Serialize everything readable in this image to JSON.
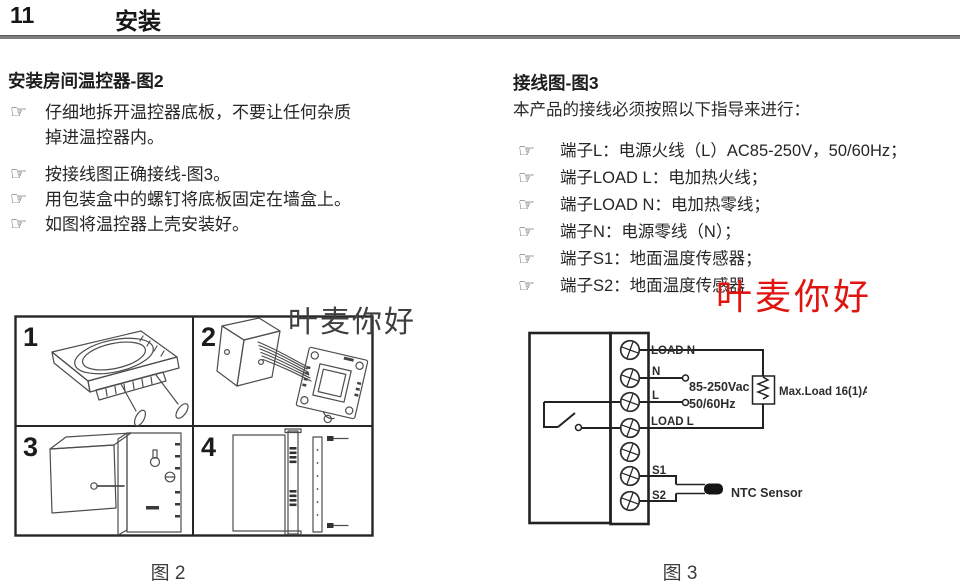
{
  "header": {
    "section_number": "11",
    "section_title": "安装"
  },
  "icons": {
    "hand": "☞"
  },
  "left": {
    "heading": "安装房间温控器-图2",
    "bullets": [
      "仔细地拆开温控器底板，不要让任何杂质掉进温控器内。",
      "按接线图正确接线-图3。",
      "用包装盒中的螺钉将底板固定在墙盒上。",
      "如图将温控器上壳安装好。"
    ],
    "figure": {
      "panels": [
        "1",
        "2",
        "3",
        "4"
      ],
      "caption": "图 2"
    }
  },
  "right": {
    "heading": "接线图-图3",
    "intro": "本产品的接线必须按照以下指导来进行：",
    "bullets": [
      "端子L：电源火线（L）AC85-250V，50/60Hz；",
      "端子LOAD L：电加热火线；",
      "端子LOAD N：电加热零线；",
      "端子N：电源零线（N）；",
      "端子S1：地面温度传感器；",
      "端子S2：地面温度传感器"
    ],
    "figure": {
      "terminals": [
        "LOAD N",
        "N",
        "L",
        "LOAD L",
        "S1",
        "S2"
      ],
      "voltage": "85-250Vac",
      "frequency": "50/60Hz",
      "max_load": "Max.Load 16(1)A",
      "sensor": "NTC Sensor",
      "caption": "图 3"
    }
  },
  "watermarks": {
    "black": "叶麦你好",
    "red": "叶麦你好"
  },
  "colors": {
    "watermark_red": "#e01510",
    "body_text": "#262626"
  }
}
